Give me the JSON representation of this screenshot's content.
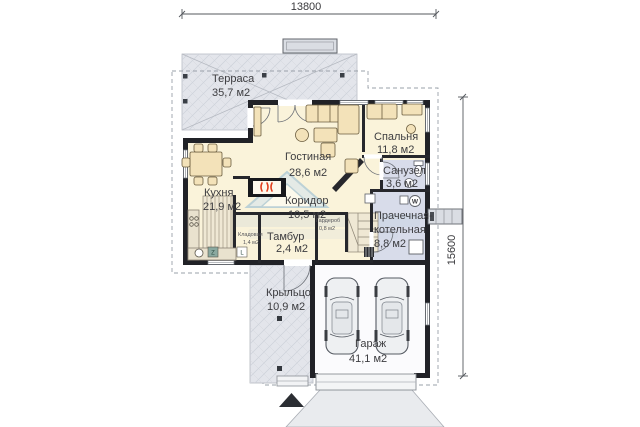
{
  "plan": {
    "dimensions": {
      "top": "13800",
      "right": "15600"
    },
    "rooms": {
      "terrace": {
        "name": "Терраса",
        "area": "35,7 м2"
      },
      "living": {
        "name": "Гостиная",
        "area": "28,6 м2"
      },
      "bedroom": {
        "name": "Спальня",
        "area": "11,8 м2"
      },
      "bathroom": {
        "name": "Санузел",
        "area": "3,6 м2"
      },
      "kitchen": {
        "name": "Кухня",
        "area": "21,9 м2"
      },
      "corridor": {
        "name": "Коридор",
        "area": "10,5 м2"
      },
      "vestibule": {
        "name": "Тамбур",
        "area": "2,4 м2"
      },
      "laundry": {
        "name1": "Прачечная-",
        "name2": "котельная",
        "area": "8,8 м2"
      },
      "wardrobe": {
        "name": "Гардероб",
        "area": "0,8 м2"
      },
      "pantry": {
        "name": "Кладовая",
        "area": "1,4 м2"
      },
      "porch": {
        "name": "Крыльцо",
        "area": "10,9 м2"
      },
      "garage": {
        "name": "Гараж",
        "area": "41,1 м2"
      }
    },
    "icons": {
      "washer_label": "W",
      "appliance_z": "Z",
      "appliance_l": "L"
    },
    "colors": {
      "wall": "#212227",
      "floor": "#faf3da",
      "wet_floor": "#d8dcea",
      "paved": "#e3e5eb",
      "furniture": "#f3e2b9",
      "fireplace_flame": "#e2401f",
      "watermark": "#a9c8e2"
    }
  }
}
